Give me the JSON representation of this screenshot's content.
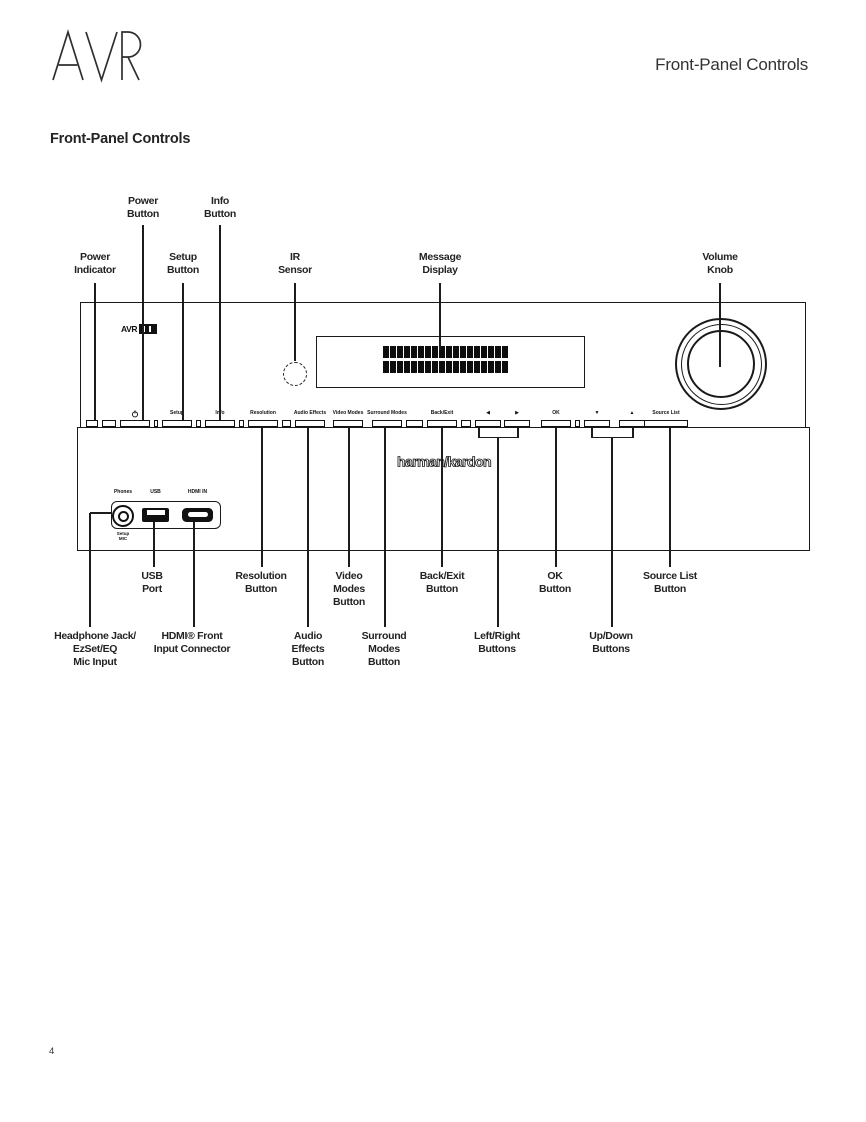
{
  "page": {
    "logo_text": "AVR",
    "header_right": "Front-Panel Controls",
    "section_title": "Front-Panel Controls",
    "page_number": "4"
  },
  "device": {
    "badge_text": "AVR",
    "brand": "harman/kardon",
    "display": {
      "rows": 2,
      "cols": 18
    },
    "ports": {
      "phones": "Phones",
      "usb": "USB",
      "hdmi": "HDMI IN",
      "mic_line1": "Setup",
      "mic_line2": "MIC"
    },
    "panel_buttons": [
      {
        "name": "power",
        "icon": "power-icon",
        "x": 135,
        "w": 30
      },
      {
        "name": "setup",
        "label": "Setup",
        "x": 177,
        "w": 30
      },
      {
        "name": "info",
        "label": "Info",
        "x": 220,
        "w": 30
      },
      {
        "name": "resolution",
        "label": "Resolution",
        "x": 263,
        "w": 30
      },
      {
        "name": "audio-effects",
        "label": "Audio Effects",
        "x": 310,
        "w": 30
      },
      {
        "name": "video-modes",
        "label": "Video Modes",
        "x": 348,
        "w": 30
      },
      {
        "name": "surround-modes",
        "label": "Surround Modes",
        "x": 387,
        "w": 30
      },
      {
        "name": "back-exit",
        "label": "Back/Exit",
        "x": 442,
        "w": 30
      },
      {
        "name": "left",
        "label": "◀",
        "x": 488,
        "w": 26
      },
      {
        "name": "right",
        "label": "▶",
        "x": 517,
        "w": 26
      },
      {
        "name": "ok",
        "label": "OK",
        "x": 556,
        "w": 30
      },
      {
        "name": "down",
        "label": "▼",
        "x": 597,
        "w": 26
      },
      {
        "name": "up",
        "label": "▲",
        "x": 632,
        "w": 26
      },
      {
        "name": "source-list",
        "label": "Source List",
        "x": 666,
        "w": 44
      }
    ]
  },
  "callouts_top": [
    {
      "name": "power-indicator",
      "lines": [
        "Power",
        "Indicator"
      ],
      "x": 95,
      "label_top": 251,
      "y1": 283,
      "y2": 420
    },
    {
      "name": "power-button",
      "lines": [
        "Power",
        "Button"
      ],
      "x": 143,
      "label_top": 195,
      "y1": 225,
      "y2": 420
    },
    {
      "name": "setup-button",
      "lines": [
        "Setup",
        "Button"
      ],
      "x": 183,
      "label_top": 251,
      "y1": 283,
      "y2": 420
    },
    {
      "name": "info-button",
      "lines": [
        "Info",
        "Button"
      ],
      "x": 220,
      "label_top": 195,
      "y1": 225,
      "y2": 420
    },
    {
      "name": "ir-sensor",
      "lines": [
        "IR",
        "Sensor"
      ],
      "x": 295,
      "label_top": 251,
      "y1": 283,
      "y2": 361
    },
    {
      "name": "message-display",
      "lines": [
        "Message",
        "Display"
      ],
      "x": 440,
      "label_top": 251,
      "y1": 283,
      "y2": 350
    },
    {
      "name": "volume-knob",
      "lines": [
        "Volume",
        "Knob"
      ],
      "x": 720,
      "label_top": 251,
      "y1": 283,
      "y2": 367
    }
  ],
  "callouts_bottom": [
    {
      "name": "headphone-jack",
      "lines": [
        "Headphone Jack/",
        "EzSet/EQ",
        "Mic Input"
      ],
      "x": 90,
      "label_x": 95,
      "label_top": 630,
      "y1": 513,
      "y2": 627,
      "elbow": {
        "y": 513,
        "x2": 112
      }
    },
    {
      "name": "usb-port",
      "lines": [
        "USB",
        "Port"
      ],
      "x": 154,
      "label_x": 152,
      "label_top": 570,
      "y1": 522,
      "y2": 567
    },
    {
      "name": "hdmi-front-input",
      "lines": [
        "HDMI® Front",
        "Input Connector"
      ],
      "x": 194,
      "label_x": 192,
      "label_top": 630,
      "y1": 522,
      "y2": 627
    },
    {
      "name": "resolution-button",
      "lines": [
        "Resolution",
        "Button"
      ],
      "x": 262,
      "label_x": 261,
      "label_top": 570,
      "y1": 428,
      "y2": 567
    },
    {
      "name": "audio-effects-button",
      "lines": [
        "Audio",
        "Effects",
        "Button"
      ],
      "x": 308,
      "label_top": 630,
      "y1": 428,
      "y2": 627
    },
    {
      "name": "video-modes-button",
      "lines": [
        "Video",
        "Modes",
        "Button"
      ],
      "x": 349,
      "label_top": 570,
      "y1": 428,
      "y2": 567
    },
    {
      "name": "surround-modes-button",
      "lines": [
        "Surround",
        "Modes",
        "Button"
      ],
      "x": 385,
      "label_x": 384,
      "label_top": 630,
      "y1": 428,
      "y2": 627
    },
    {
      "name": "back-exit-button",
      "lines": [
        "Back/Exit",
        "Button"
      ],
      "x": 442,
      "label_top": 570,
      "y1": 428,
      "y2": 567
    },
    {
      "name": "left-right-buttons",
      "lines": [
        "Left/Right",
        "Buttons"
      ],
      "x": 498,
      "label_x": 497,
      "label_top": 630,
      "y1": 437,
      "y2": 627,
      "bracket": {
        "x1": 479,
        "x2": 518,
        "y_top": 427,
        "y_bar": 437
      }
    },
    {
      "name": "ok-button",
      "lines": [
        "OK",
        "Button"
      ],
      "x": 556,
      "label_x": 555,
      "label_top": 570,
      "y1": 428,
      "y2": 567
    },
    {
      "name": "up-down-buttons",
      "lines": [
        "Up/Down",
        "Buttons"
      ],
      "x": 612,
      "label_x": 611,
      "label_top": 630,
      "y1": 437,
      "y2": 627,
      "bracket": {
        "x1": 592,
        "x2": 633,
        "y_top": 427,
        "y_bar": 437
      }
    },
    {
      "name": "source-list-button",
      "lines": [
        "Source List",
        "Button"
      ],
      "x": 670,
      "label_top": 570,
      "y1": 428,
      "y2": 567
    }
  ]
}
